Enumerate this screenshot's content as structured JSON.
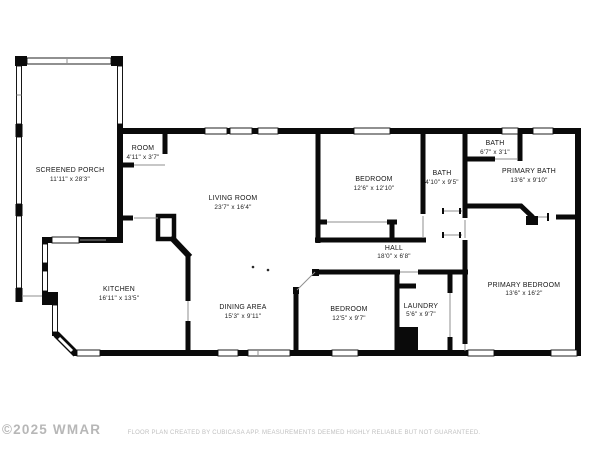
{
  "rooms": [
    {
      "id": "screened-porch",
      "name": "SCREENED PORCH",
      "dimensions": "11'11\" x 28'3\""
    },
    {
      "id": "room",
      "name": "ROOM",
      "dimensions": "4'11\" x 3'7\""
    },
    {
      "id": "living-room",
      "name": "LIVING ROOM",
      "dimensions": "23'7\" x 16'4\""
    },
    {
      "id": "kitchen",
      "name": "KITCHEN",
      "dimensions": "16'11\" x 13'5\""
    },
    {
      "id": "dining-area",
      "name": "DINING AREA",
      "dimensions": "15'3\" x 9'11\""
    },
    {
      "id": "bedroom",
      "name": "BEDROOM",
      "dimensions": "12'6\" x 12'10\""
    },
    {
      "id": "bath",
      "name": "BATH",
      "dimensions": "4'10\" x 9'5\""
    },
    {
      "id": "bath-2",
      "name": "BATH",
      "dimensions": "6'7\" x 3'1\""
    },
    {
      "id": "primary-bath",
      "name": "PRIMARY BATH",
      "dimensions": "13'6\" x 9'10\""
    },
    {
      "id": "hall",
      "name": "HALL",
      "dimensions": "18'0\" x 6'8\""
    },
    {
      "id": "bedroom-2",
      "name": "BEDROOM",
      "dimensions": "12'5\" x 9'7\""
    },
    {
      "id": "laundry",
      "name": "LAUNDRY",
      "dimensions": "5'6\" x 9'7\""
    },
    {
      "id": "primary-bedroom",
      "name": "PRIMARY BEDROOM",
      "dimensions": "13'6\" x 16'2\""
    }
  ],
  "footer": {
    "copyright": "©2025 WMAR",
    "disclaimer": "FLOOR PLAN CREATED BY CUBICASA APP. MEASUREMENTS DEEMED HIGHLY RELIABLE BUT NOT GUARANTEED."
  },
  "colors": {
    "wall": "#0a0a0a",
    "window_fill": "#ffffff",
    "label_text": "#151515",
    "muted_text": "#c0c0c0",
    "watermark": "#ababab"
  }
}
